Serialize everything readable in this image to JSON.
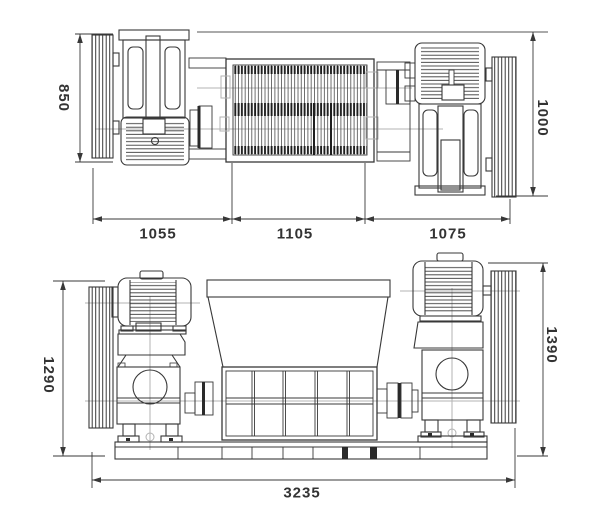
{
  "drawing": {
    "colors": {
      "line": "#383838",
      "centerline": "#b3b3b3",
      "text": "#333333",
      "background": "#ffffff"
    },
    "dimensions": {
      "top_view": {
        "left_height": "850",
        "right_height": "1000",
        "bottom_left": "1055",
        "bottom_middle": "1105",
        "bottom_right": "1075"
      },
      "front_view": {
        "left_height": "1290",
        "right_height": "1390",
        "overall_width": "3235"
      }
    }
  }
}
